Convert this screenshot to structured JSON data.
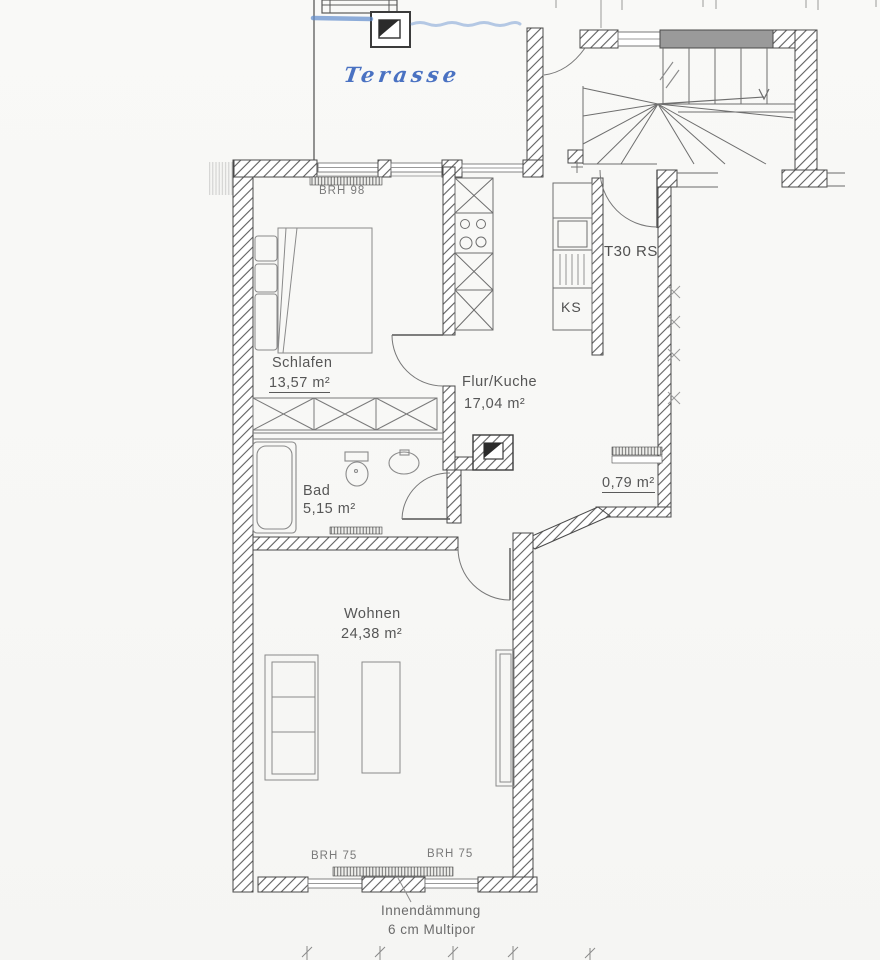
{
  "plan": {
    "title": "apartment floor plan (scanned)",
    "colors": {
      "background": "#f8f8f6",
      "line_ink": "#4a4a4a",
      "hatch": "#5f5f5f",
      "gray_wall_fill": "#9a9a9a",
      "highlighter_blue": "#5f8ccc",
      "handwriting_blue": "#3c67be",
      "label_gray": "#565656"
    }
  },
  "labels": {
    "terrace": "Terasse",
    "window_top": "BRH 98",
    "fire_door": "T30 RS",
    "fridge": "KS",
    "bedroom": {
      "name": "Schlafen",
      "area": "13,57 m²"
    },
    "hall_kitchen": {
      "name": "Flur/Kuche",
      "area": "17,04 m²"
    },
    "bath": {
      "name": "Bad",
      "area": "5,15 m²"
    },
    "niche_area": "0,79 m²",
    "living": {
      "name": "Wohnen",
      "area": "24,38 m²"
    },
    "window_bottom_left": "BRH 75",
    "window_bottom_right": "BRH 75",
    "insulation_note_line1": "Innendämmung",
    "insulation_note_line2": "6 cm Multipor"
  }
}
